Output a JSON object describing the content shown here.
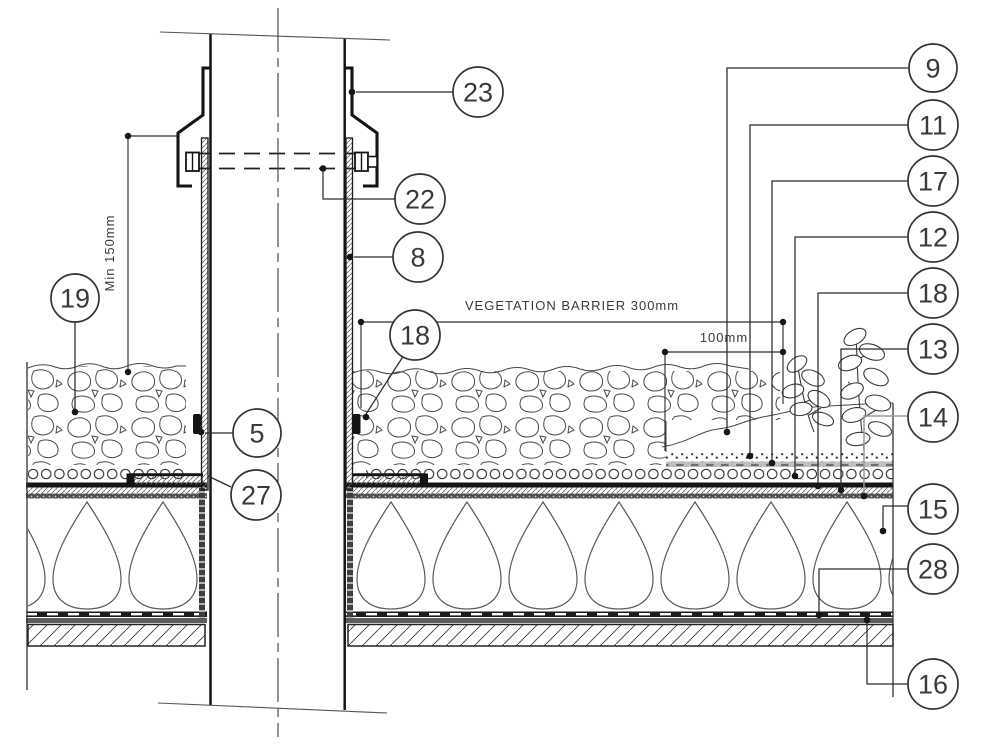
{
  "colors": {
    "ink": "#2b2b2b",
    "leader_gray": "#9a9a9a",
    "background": "#ffffff"
  },
  "dimensions": {
    "min_upstand_height": "Min 150mm",
    "vegetation_barrier": "VEGETATION BARRIER 300mm",
    "barrier_strip_width": "100mm"
  },
  "callouts": {
    "c23": {
      "label": "23"
    },
    "c22": {
      "label": "22"
    },
    "c8": {
      "label": "8"
    },
    "c18_pipe": {
      "label": "18"
    },
    "c19": {
      "label": "19"
    },
    "c5": {
      "label": "5"
    },
    "c27": {
      "label": "27"
    },
    "c9": {
      "label": "9"
    },
    "c11": {
      "label": "11"
    },
    "c17": {
      "label": "17"
    },
    "c12": {
      "label": "12"
    },
    "c18_roof": {
      "label": "18"
    },
    "c13": {
      "label": "13"
    },
    "c14": {
      "label": "14"
    },
    "c15": {
      "label": "15"
    },
    "c28": {
      "label": "28"
    },
    "c16": {
      "label": "16"
    }
  }
}
